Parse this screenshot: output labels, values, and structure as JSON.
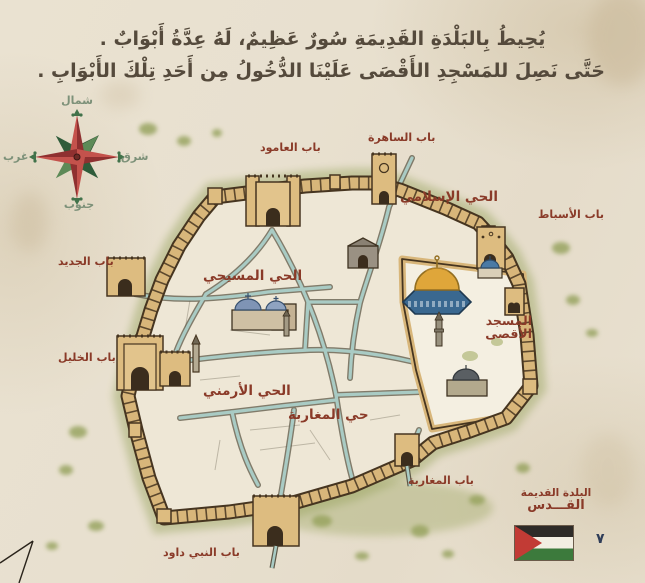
{
  "header": {
    "line1": "يُحِيطُ بِالبَلْدَةِ القَدِيمَةِ سُورٌ عَظِيمٌ، لَهُ عِدَّةُ أَبْوَابٌ .",
    "line2": "حَتَّى نَصِلَ للمَسْجِدِ الأَقْصَى عَلَيْنَا الدُّخُولُ مِن أَحَدِ تِلْكَ الأَبْوَابِ ."
  },
  "compass": {
    "north": "شمال",
    "south": "جنوب",
    "east": "شرق",
    "west": "غرب"
  },
  "map": {
    "gates": {
      "bab_alamud": "باب العامود",
      "bab_alsahira": "باب الساهرة",
      "bab_alasbat": "باب الأسباط",
      "bab_aljadid": "باب الجديد",
      "bab_alkhalil": "باب الخليل",
      "bab_almagharba": "باب المغاربة",
      "bab_alnabi_dawud": "باب النبي داود"
    },
    "quarters": {
      "islamic": "الحي الإسلامي",
      "christian": "الحي المسيحي",
      "armenian": "الحي الأرمني",
      "magharba": "حي المغاربة"
    },
    "landmarks": {
      "aqsa_line1": "المسجد",
      "aqsa_line2": "الأقصى"
    },
    "icons": {
      "compass": "compass-rose-icon",
      "flag": "palestine-flag-icon",
      "fold": "page-corner-fold-icon"
    }
  },
  "legend": {
    "line1": "البلدة القديمة",
    "line2": "القـــدس"
  },
  "footer": {
    "page_number": "٧"
  },
  "colors": {
    "parchment": "#e9e1d0",
    "label_brown": "#8a3a28",
    "title_gray": "#554a3c",
    "wall_tan": "#d8b67a",
    "wall_outline": "#463520",
    "street_teal": "#a9cbc4",
    "green_wash": "#96a35c",
    "compass_red": "#b24440",
    "compass_green": "#41724a",
    "dome_gold": "#dfa63a",
    "dome_blue": "#3a6890",
    "flag_red": "#c23b35",
    "flag_green": "#3c7a3c",
    "page_number_navy": "#2f3d58"
  }
}
